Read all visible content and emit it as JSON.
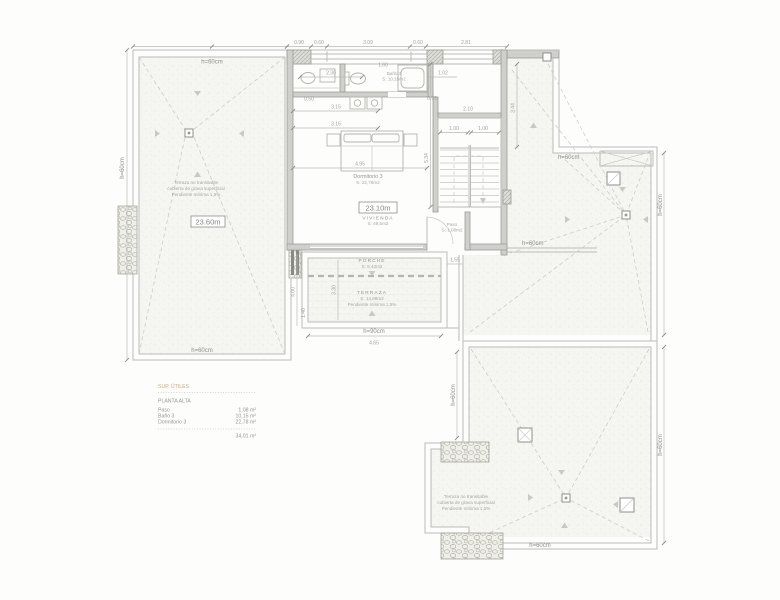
{
  "colors": {
    "accent": "#c9a87f",
    "line": "#bcbcb7",
    "wall": "#cfcfcb",
    "text": "#9a9a95"
  },
  "labels": {
    "h60": "h=60cm",
    "h90": "h=90cm",
    "level_terrace": "23.60m",
    "level_floor": "23.10m",
    "terrace_note": {
      "l1": "Terraza no transitable",
      "l2": "cubierta de grava superficial",
      "l3": "Pendiente mínima 1,5%"
    }
  },
  "rooms": {
    "bano": {
      "name": "Baño 3",
      "area": "S: 10,15m2"
    },
    "dormitorio": {
      "name": "Dormitorio 3",
      "area": "S: 22,78m2"
    },
    "vivienda": {
      "name": "VIVIENDA",
      "area": "S: 49,5m2"
    },
    "paso": {
      "name": "Paso",
      "area": "S: 1,08m2"
    },
    "porche": {
      "name": "PORCHE",
      "area": "S: 9,43m2"
    },
    "terraza": {
      "name": "TERRAZA",
      "area": "S: 14,86m2",
      "note": "Pendiente mínima 1,5%"
    }
  },
  "dims": {
    "t1": "0.90",
    "t2": "0.60",
    "t3": "3.09",
    "t4": "0.60",
    "t5": "2.81",
    "a1": "2.30",
    "a2": "1.60",
    "a3": "1.02",
    "a4": "0.50",
    "a5": "3.15",
    "a6": "3.15",
    "a7": "4.95",
    "a8": "0.93",
    "s1": "2.10",
    "s2": "1.00",
    "s3": "1.00",
    "v1": "5.34",
    "v2": "3.44",
    "p1": "1.55",
    "p2": "3.30",
    "p3": "4.00",
    "p4": "1.40",
    "b1": "4.65"
  },
  "legend": {
    "header": "SUP. ÚTILES",
    "floor": "PLANTA ALTA",
    "rows": [
      {
        "name": "Paso",
        "value": "1,08 m²"
      },
      {
        "name": "Baño 3",
        "value": "10,15 m²"
      },
      {
        "name": "Dormitorio 3",
        "value": "22,78 m²"
      }
    ],
    "total": "34,01 m²"
  }
}
